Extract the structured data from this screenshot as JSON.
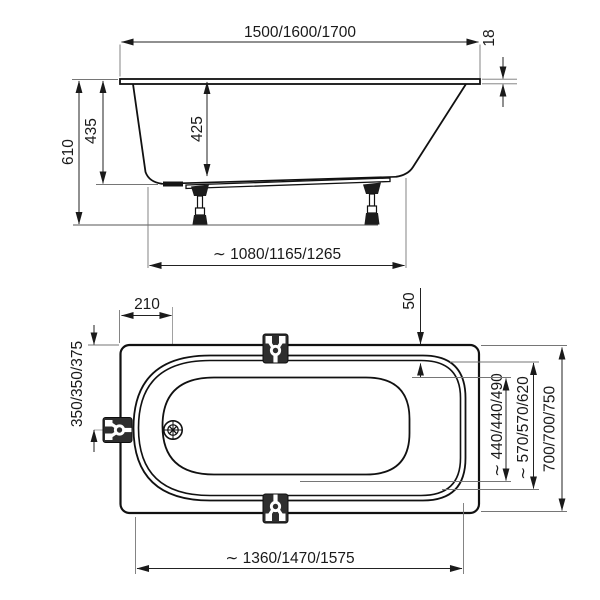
{
  "drawing": {
    "title": "bathtub-dimension-drawing",
    "colors": {
      "line": "#1a1a1a",
      "background": "#ffffff",
      "hardware": "#2e2e2e"
    },
    "side_view": {
      "length_label": "1500/1600/1700",
      "rim_thickness_label": "18",
      "total_height_label": "610",
      "shell_height_label": "435",
      "inner_depth_label": "425",
      "base_length_label": "∼ 1080/1165/1265"
    },
    "plan_view": {
      "drain_offset_label": "210",
      "foot_end_rim_label": "50",
      "drain_to_edge_label": "350/350/375",
      "bottom_width_label": "∼ 440/440/490",
      "inner_width_label": "∼ 570/570/620",
      "overall_width_label": "700/700/750",
      "rim_length_label": "∼ 1360/1470/1575"
    }
  }
}
